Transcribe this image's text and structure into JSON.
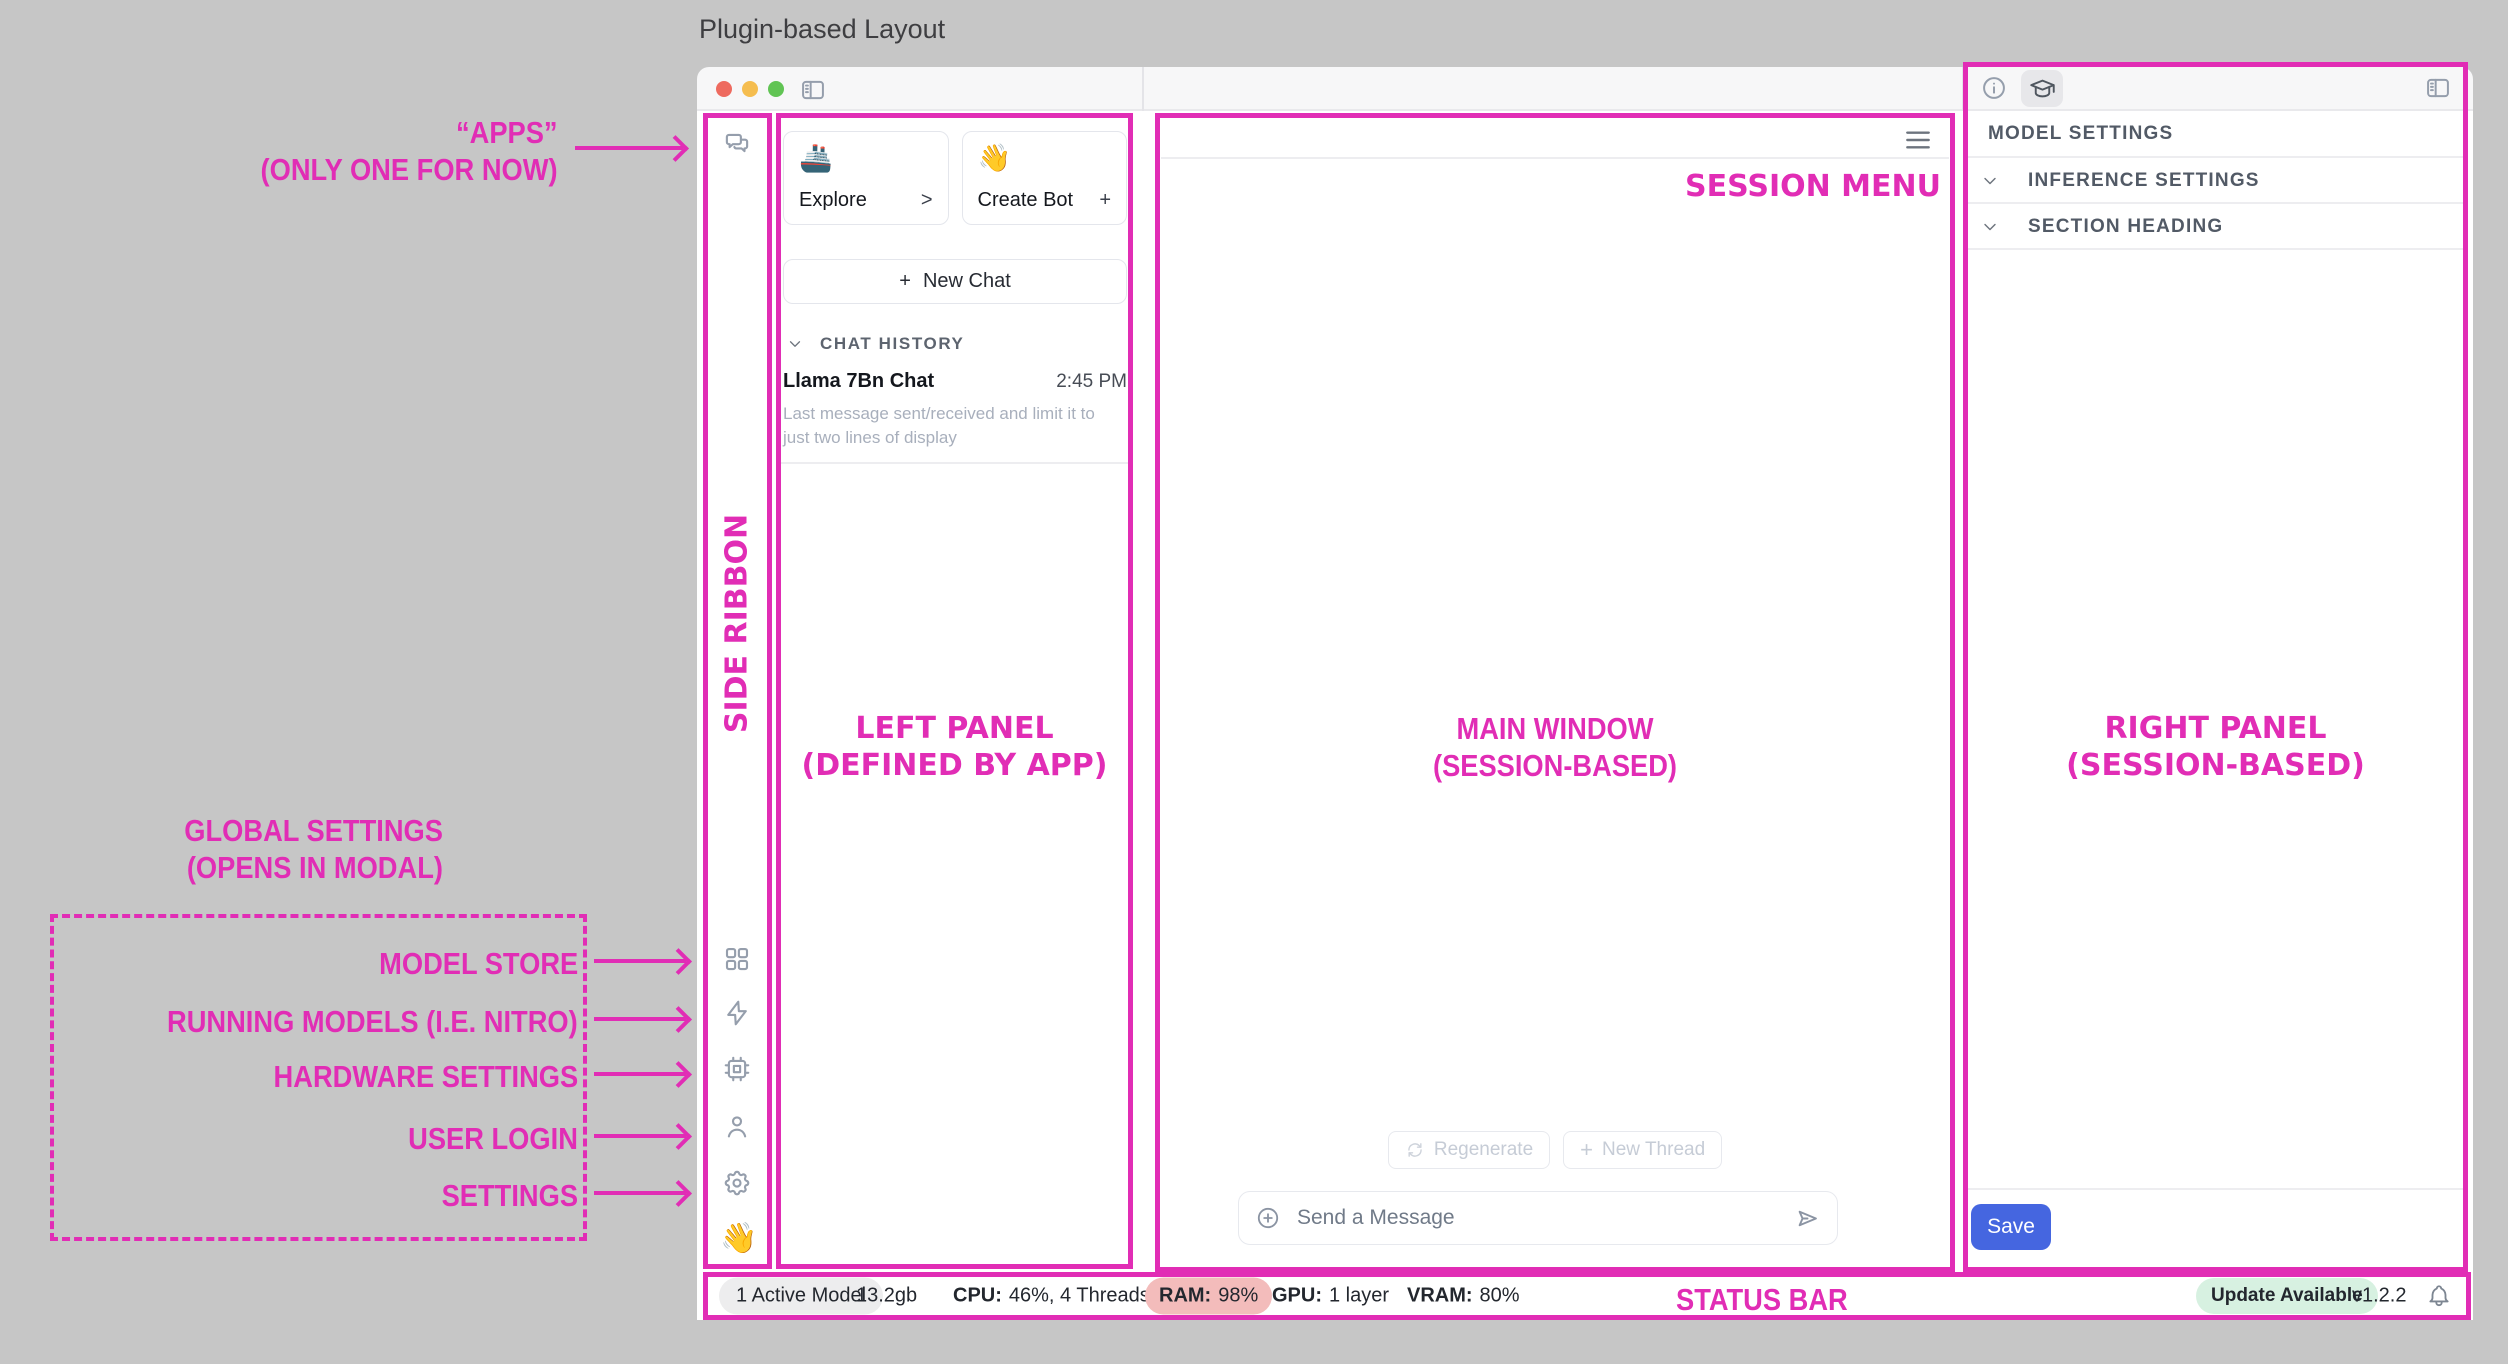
{
  "page_title": "Plugin-based Layout",
  "colors": {
    "annotation_pink": "#e12db5",
    "save_blue": "#4566e0",
    "ram_warning_bg": "#f3bcbb",
    "update_ok_bg": "#d7f1e1",
    "traffic_lights": [
      "#ee6a5f",
      "#f5bd4f",
      "#61c454"
    ]
  },
  "annotations": {
    "apps_line1": "“APPS”",
    "apps_line2": "(ONLY ONE FOR NOW)",
    "side_ribbon": "SIDE RIBBON",
    "left_panel_line1": "LEFT PANEL",
    "left_panel_line2": "(DEFINED BY APP)",
    "main_window_line1": "MAIN WINDOW",
    "main_window_line2": "(SESSION-BASED)",
    "right_panel_line1": "RIGHT PANEL",
    "right_panel_line2": "(SESSION-BASED)",
    "session_menu": "SESSION MENU",
    "status_bar": "STATUS BAR",
    "global_settings_line1": "GLOBAL SETTINGS",
    "global_settings_line2": "(OPENS IN MODAL)",
    "ribbon_targets": [
      "MODEL STORE",
      "RUNNING MODELS (I.E. NITRO)",
      "HARDWARE SETTINGS",
      "USER LOGIN",
      "SETTINGS"
    ]
  },
  "ribbon": {
    "chat_icon": "chat-bubbles",
    "bottom_icons": [
      "model-store-grid",
      "running-models-bolt",
      "hardware-chip",
      "user",
      "settings-gear"
    ],
    "wave_emoji": "👋"
  },
  "left_panel": {
    "cards": [
      {
        "emoji": "🚢",
        "label": "Explore",
        "affordance": ">"
      },
      {
        "emoji": "👋",
        "label": "Create Bot",
        "affordance": "+"
      }
    ],
    "new_chat_plus": "+",
    "new_chat_label": "New Chat",
    "chat_history_label": "CHAT HISTORY",
    "chats": [
      {
        "title": "Llama 7Bn Chat",
        "time": "2:45 PM",
        "preview": "Last message sent/received and limit it to just two lines of display"
      }
    ]
  },
  "main": {
    "regenerate_label": "Regenerate",
    "new_thread_plus": "+",
    "new_thread_label": "New Thread",
    "message_placeholder": "Send a Message"
  },
  "right_panel": {
    "sections": [
      "MODEL SETTINGS",
      "INFERENCE SETTINGS",
      "SECTION HEADING"
    ],
    "save_label": "Save"
  },
  "status_bar": {
    "active_model": "1 Active Model",
    "memory_size": "13.2gb",
    "cpu_label": "CPU:",
    "cpu_value": "46%, 4 Threads",
    "ram_label": "RAM:",
    "ram_value": "98%",
    "gpu_label": "GPU:",
    "gpu_value": "1 layer",
    "vram_label": "VRAM:",
    "vram_value": "80%",
    "update_label": "Update Available",
    "version": "v1.2.2"
  }
}
